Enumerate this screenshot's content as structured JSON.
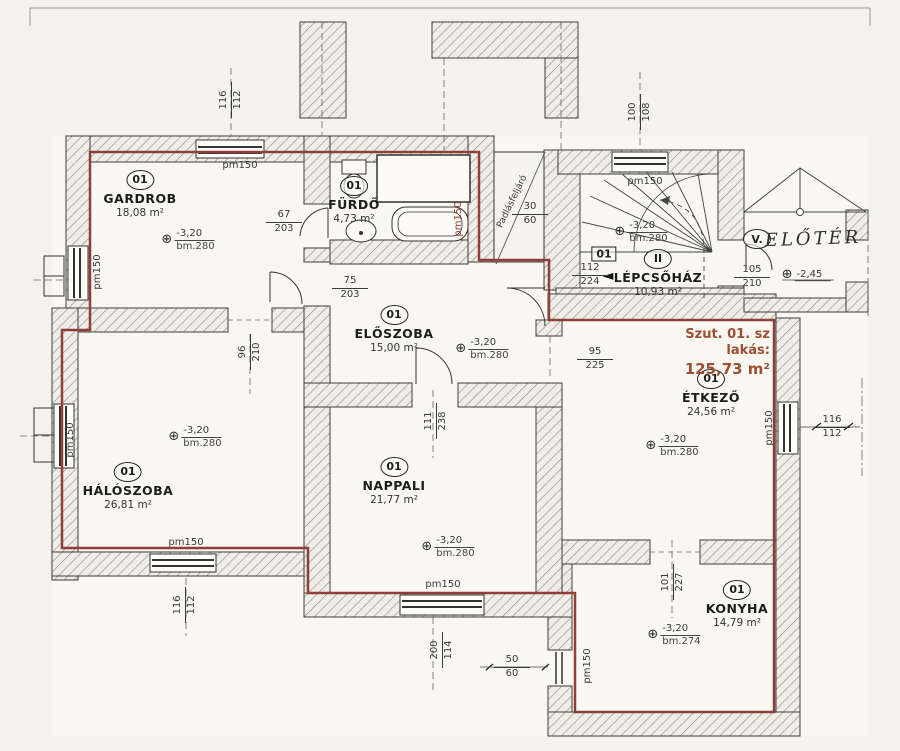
{
  "plan": {
    "apartment_label": "Szut. 01. sz lakás:",
    "apartment_area": "125,73 m²",
    "accent_color": "#9c4f32",
    "boundary_color": "#8e4037"
  },
  "symbols": {
    "level_marker": "⊕"
  },
  "rooms": [
    {
      "number": "01",
      "name": "GARDROB",
      "area": "18,08 m²"
    },
    {
      "number": "01",
      "name": "FÜRDŐ",
      "area": "4,73 m²"
    },
    {
      "number": "01",
      "name": "ELŐSZOBA",
      "area": "15,00 m²"
    },
    {
      "number": "II",
      "name": "LÉPCSŐHÁZ",
      "area": "10,93 m²"
    },
    {
      "number": "V.",
      "name": "ELŐTÉR",
      "area": ""
    },
    {
      "number": "01",
      "name": "ÉTKEZŐ",
      "area": "24,56 m²"
    },
    {
      "number": "01",
      "name": "HÁLÓSZOBA",
      "area": "26,81 m²"
    },
    {
      "number": "01",
      "name": "NAPPALI",
      "area": "21,77 m²"
    },
    {
      "number": "01",
      "name": "KONYHA",
      "area": "14,79 m²"
    }
  ],
  "stairwell": {
    "unit_badge": "01",
    "arrow": "◄"
  },
  "labels": [
    {
      "k": "t",
      "t": "pm150",
      "x": 240,
      "y": 166
    },
    {
      "k": "t",
      "t": "pm150",
      "x": 645,
      "y": 182
    },
    {
      "k": "t",
      "t": "pm150",
      "x": 98,
      "y": 272,
      "r": -90
    },
    {
      "k": "t",
      "t": "pm150",
      "x": 71,
      "y": 440,
      "r": -90
    },
    {
      "k": "t",
      "t": "pm150",
      "x": 186,
      "y": 543
    },
    {
      "k": "t",
      "t": "pm150",
      "x": 443,
      "y": 585
    },
    {
      "k": "t",
      "t": "pm150",
      "x": 588,
      "y": 666,
      "r": -90
    },
    {
      "k": "t",
      "t": "pm150",
      "x": 770,
      "y": 428,
      "r": -90
    },
    {
      "k": "t",
      "t": "pm150",
      "x": 459,
      "y": 219,
      "r": -90,
      "c": "#8e4037"
    },
    {
      "k": "t",
      "t": "Padlásfeljáró",
      "x": 513,
      "y": 202,
      "r": -64,
      "s": 9
    },
    {
      "k": "f",
      "a": "67",
      "b": "203",
      "x": 284,
      "y": 222
    },
    {
      "k": "f",
      "a": "75",
      "b": "203",
      "x": 350,
      "y": 288
    },
    {
      "k": "f",
      "a": "30",
      "b": "60",
      "x": 530,
      "y": 214
    },
    {
      "k": "f",
      "a": "112",
      "b": "224",
      "x": 590,
      "y": 275
    },
    {
      "k": "f",
      "a": "105",
      "b": "210",
      "x": 752,
      "y": 277
    },
    {
      "k": "f",
      "a": "95",
      "b": "225",
      "x": 595,
      "y": 359
    },
    {
      "k": "f",
      "a": "50",
      "b": "60",
      "x": 512,
      "y": 667
    },
    {
      "k": "f",
      "a": "116",
      "b": "112",
      "x": 832,
      "y": 427
    },
    {
      "k": "v",
      "a": "116",
      "b": "112",
      "x": 231,
      "y": 100
    },
    {
      "k": "v",
      "a": "100",
      "b": "108",
      "x": 640,
      "y": 112
    },
    {
      "k": "v",
      "a": "96",
      "b": "210",
      "x": 250,
      "y": 352
    },
    {
      "k": "v",
      "a": "111",
      "b": "238",
      "x": 436,
      "y": 421
    },
    {
      "k": "v",
      "a": "116",
      "b": "112",
      "x": 185,
      "y": 605
    },
    {
      "k": "v",
      "a": "200",
      "b": "114",
      "x": 442,
      "y": 650
    },
    {
      "k": "v",
      "a": "101",
      "b": "227",
      "x": 673,
      "y": 582
    },
    {
      "k": "l",
      "a": "-3,20",
      "b": "bm.280",
      "x": 188,
      "y": 240
    },
    {
      "k": "l",
      "a": "-3,20",
      "b": "bm.280",
      "x": 482,
      "y": 349
    },
    {
      "k": "l",
      "a": "-3,20",
      "b": "bm.280",
      "x": 641,
      "y": 232
    },
    {
      "k": "l",
      "a": "-3,20",
      "b": "bm.280",
      "x": 672,
      "y": 446
    },
    {
      "k": "l",
      "a": "-3,20",
      "b": "bm.280",
      "x": 195,
      "y": 437
    },
    {
      "k": "l",
      "a": "-3,20",
      "b": "bm.280",
      "x": 448,
      "y": 547
    },
    {
      "k": "l",
      "a": "-3,20",
      "b": "bm.274",
      "x": 674,
      "y": 635
    },
    {
      "k": "l",
      "a": "-2,45",
      "b": "",
      "x": 806,
      "y": 275
    }
  ]
}
